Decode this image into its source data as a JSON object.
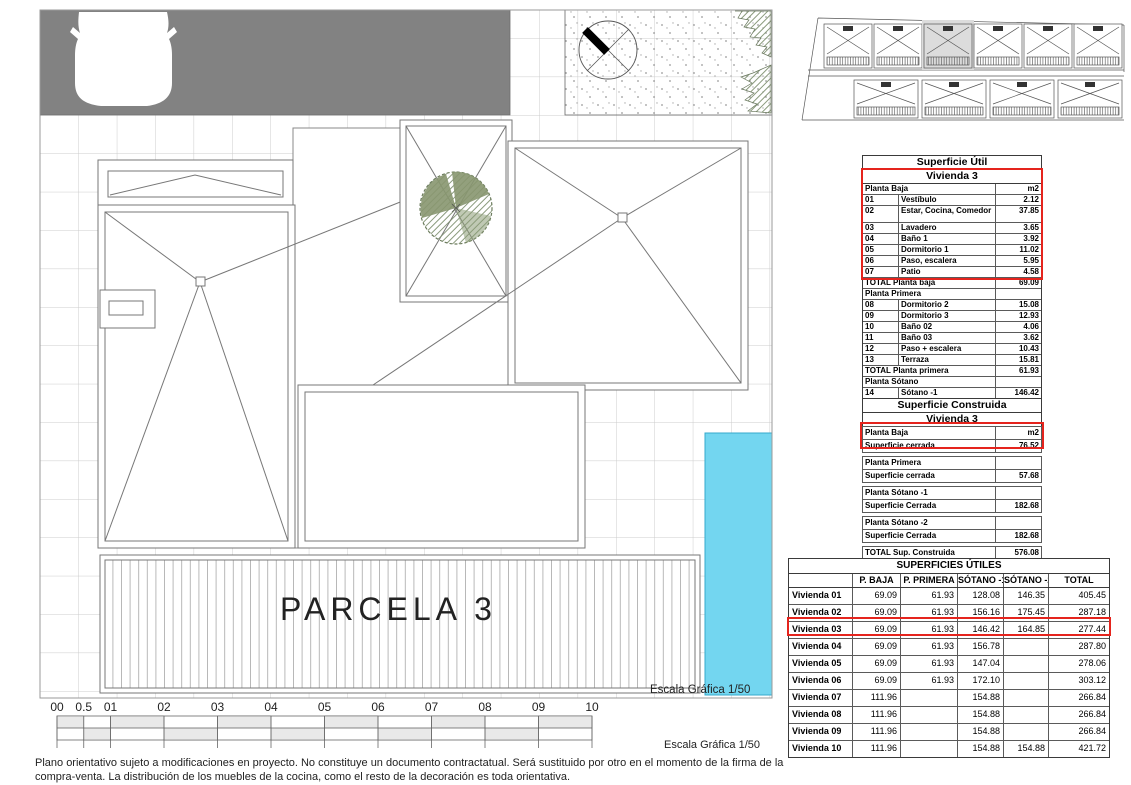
{
  "plan": {
    "parcel_label": "PARCELA 3",
    "scale_label_inner": "Escala Gráfica 1/50",
    "scale_label_outer": "Escala Gráfica 1/50",
    "scale_ticks": [
      "00",
      "0.5",
      "01",
      "02",
      "03",
      "04",
      "05",
      "06",
      "07",
      "08",
      "09",
      "10"
    ],
    "colors": {
      "pool": "#73d6f0",
      "road": "#828282",
      "highlight_red": "#e5241d",
      "tree": "#87966f"
    }
  },
  "tables": {
    "util": {
      "title": "Superficie Útil",
      "subtitle": "Vivienda 3",
      "rows": [
        [
          "Planta Baja",
          "",
          "m2",
          "sec"
        ],
        [
          "01",
          "Vestíbulo",
          "2.12",
          ""
        ],
        [
          "02",
          "Estar, Cocina, Comedor",
          "37.85",
          "tall"
        ],
        [
          "03",
          "Lavadero",
          "3.65",
          ""
        ],
        [
          "04",
          "Baño 1",
          "3.92",
          ""
        ],
        [
          "05",
          "Dormitorio 1",
          "11.02",
          ""
        ],
        [
          "06",
          "Paso, escalera",
          "5.95",
          ""
        ],
        [
          "07",
          "Patio",
          "4.58",
          ""
        ],
        [
          "TOTAL Planta baja",
          "",
          "69.09",
          "total"
        ],
        [
          "Planta Primera",
          "",
          "",
          "sec"
        ],
        [
          "08",
          "Dormitorio 2",
          "15.08",
          ""
        ],
        [
          "09",
          "Dormitorio 3",
          "12.93",
          ""
        ],
        [
          "10",
          "Baño 02",
          "4.06",
          ""
        ],
        [
          "11",
          "Baño 03",
          "3.62",
          ""
        ],
        [
          "12",
          "Paso + escalera",
          "10.43",
          ""
        ],
        [
          "13",
          "Terraza",
          "15.81",
          ""
        ],
        [
          "TOTAL Planta primera",
          "",
          "61.93",
          "total"
        ],
        [
          "Planta Sótano",
          "",
          "",
          "sec"
        ],
        [
          "14",
          "Sótano -1",
          "146.42",
          ""
        ],
        [
          "15",
          "Sótano -2",
          "164.85",
          ""
        ],
        [
          "TOTAL",
          "",
          "442.29",
          "total"
        ]
      ]
    },
    "construida": {
      "title": "Superficie Construida",
      "subtitle": "Vivienda 3",
      "rows": [
        [
          "Planta Baja",
          "m2",
          ""
        ],
        [
          "Superficie cerrada",
          "76.52",
          ""
        ],
        [
          "Planta Primera",
          "",
          "gap"
        ],
        [
          "Superficie cerrada",
          "57.68",
          ""
        ],
        [
          "Planta Sótano -1",
          "",
          "gap"
        ],
        [
          "Superficie Cerrada",
          "182.68",
          ""
        ],
        [
          "Planta Sótano -2",
          "",
          "gap"
        ],
        [
          "Superficie Cerrada",
          "182.68",
          ""
        ],
        [
          "TOTAL Sup. Construida",
          "576.08",
          "gap"
        ]
      ]
    },
    "superficies": {
      "title": "SUPERFICIES ÚTILES",
      "headers": [
        "",
        "P. BAJA",
        "P. PRIMERA",
        "SÓTANO -1",
        "SÓTANO -2",
        "TOTAL"
      ],
      "rows": [
        [
          "Vivienda 01",
          "69.09",
          "61.93",
          "128.08",
          "146.35",
          "405.45"
        ],
        [
          "Vivienda 02",
          "69.09",
          "61.93",
          "156.16",
          "175.45",
          "287.18"
        ],
        [
          "Vivienda 03",
          "69.09",
          "61.93",
          "146.42",
          "164.85",
          "277.44"
        ],
        [
          "Vivienda 04",
          "69.09",
          "61.93",
          "156.78",
          "",
          "287.80"
        ],
        [
          "Vivienda 05",
          "69.09",
          "61.93",
          "147.04",
          "",
          "278.06"
        ],
        [
          "Vivienda 06",
          "69.09",
          "61.93",
          "172.10",
          "",
          "303.12"
        ],
        [
          "Vivienda 07",
          "111.96",
          "",
          "154.88",
          "",
          "266.84"
        ],
        [
          "Vivienda 08",
          "111.96",
          "",
          "154.88",
          "",
          "266.84"
        ],
        [
          "Vivienda 09",
          "111.96",
          "",
          "154.88",
          "",
          "266.84"
        ],
        [
          "Vivienda 10",
          "111.96",
          "",
          "154.88",
          "154.88",
          "421.72"
        ]
      ],
      "highlight_row": 2
    }
  },
  "disclaimer": "Plano orientativo sujeto a modificaciones en proyecto. No constituye un documento contractatual. Será sustituido por otro en el momento de la firma de la compra-venta. La distribución de los muebles de la cocina, como el resto de la decoración es toda orientativa."
}
